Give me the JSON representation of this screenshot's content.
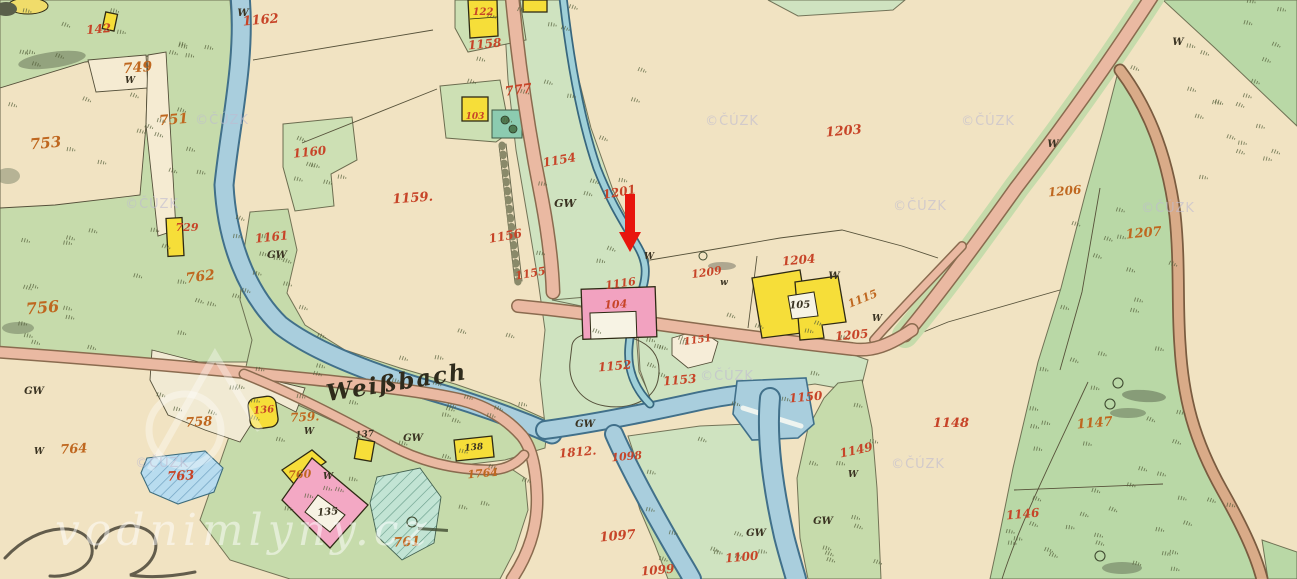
{
  "map": {
    "place_label": "Weißbach",
    "watermark_text": "vodnimlyny.cz",
    "copyright_watermark": "©ČÚZK",
    "copyright_positions": [
      [
        222,
        124
      ],
      [
        152,
        208
      ],
      [
        732,
        125
      ],
      [
        988,
        125
      ],
      [
        920,
        210
      ],
      [
        1168,
        212
      ],
      [
        162,
        467
      ],
      [
        727,
        380
      ],
      [
        918,
        468
      ]
    ],
    "arrow": {
      "x": 630,
      "y": 228,
      "color": "#e8150d"
    },
    "colors": {
      "paper_cream": "#f1e3c2",
      "meadow_green": "#c6dbab",
      "valley_green": "#cfe3c0",
      "river_blue": "#a9cedd",
      "road_pink": "#eab9a2",
      "building_yellow": "#f6de39",
      "building_pink": "#f2a2c0",
      "label_red": "#c74428",
      "label_orange": "#bf671f"
    },
    "labels": [
      {
        "t": "W",
        "x": 243,
        "y": 16,
        "c": "dark",
        "s": 10,
        "r": 0
      },
      {
        "t": "1162",
        "x": 261,
        "y": 24,
        "c": "red",
        "s": 13,
        "r": -5
      },
      {
        "t": "142",
        "x": 99,
        "y": 33,
        "c": "red",
        "s": 12,
        "r": -5
      },
      {
        "t": "749",
        "x": 138,
        "y": 72,
        "c": "orange",
        "s": 14,
        "r": -5
      },
      {
        "t": "W",
        "x": 130,
        "y": 83,
        "c": "dark",
        "s": 9,
        "r": 0
      },
      {
        "t": "751",
        "x": 174,
        "y": 124,
        "c": "orange",
        "s": 14,
        "r": -5
      },
      {
        "t": "753",
        "x": 46,
        "y": 148,
        "c": "orange",
        "s": 15,
        "r": -5
      },
      {
        "t": "1160",
        "x": 310,
        "y": 156,
        "c": "red",
        "s": 12,
        "r": -6
      },
      {
        "t": "1159.",
        "x": 413,
        "y": 202,
        "c": "red",
        "s": 13,
        "r": -4
      },
      {
        "t": "1161",
        "x": 272,
        "y": 241,
        "c": "red",
        "s": 12,
        "r": -6
      },
      {
        "t": "GW",
        "x": 277,
        "y": 258,
        "c": "dark",
        "s": 10,
        "r": 0
      },
      {
        "t": "762",
        "x": 201,
        "y": 281,
        "c": "orange",
        "s": 14,
        "r": -8
      },
      {
        "t": "756",
        "x": 43,
        "y": 313,
        "c": "orange",
        "s": 16,
        "r": -5
      },
      {
        "t": "729",
        "x": 187,
        "y": 231,
        "c": "red",
        "s": 11,
        "r": 0
      },
      {
        "t": "122",
        "x": 483,
        "y": 15,
        "c": "red",
        "s": 10,
        "r": 0
      },
      {
        "t": "1158",
        "x": 485,
        "y": 48,
        "c": "red",
        "s": 12,
        "r": -5
      },
      {
        "t": "777",
        "x": 519,
        "y": 94,
        "c": "red",
        "s": 13,
        "r": -8
      },
      {
        "t": "103",
        "x": 475,
        "y": 119,
        "c": "red",
        "s": 9,
        "r": 0
      },
      {
        "t": "1154",
        "x": 560,
        "y": 164,
        "c": "red",
        "s": 12,
        "r": -10
      },
      {
        "t": "GW",
        "x": 565,
        "y": 207,
        "c": "dark",
        "s": 11,
        "r": 0
      },
      {
        "t": "1201",
        "x": 620,
        "y": 196,
        "c": "red",
        "s": 12,
        "r": -10
      },
      {
        "t": "1156",
        "x": 506,
        "y": 240,
        "c": "red",
        "s": 12,
        "r": -10
      },
      {
        "t": "1155",
        "x": 531,
        "y": 277,
        "c": "red",
        "s": 11,
        "r": -10
      },
      {
        "t": "W",
        "x": 649,
        "y": 259,
        "c": "dark",
        "s": 9,
        "r": 0
      },
      {
        "t": "1203",
        "x": 844,
        "y": 135,
        "c": "red",
        "s": 13,
        "r": -5
      },
      {
        "t": "1209",
        "x": 707,
        "y": 276,
        "c": "red",
        "s": 11,
        "r": -8
      },
      {
        "t": "w",
        "x": 724,
        "y": 285,
        "c": "dark",
        "s": 9,
        "r": 0
      },
      {
        "t": "1204",
        "x": 799,
        "y": 264,
        "c": "red",
        "s": 12,
        "r": -5
      },
      {
        "t": "W",
        "x": 834,
        "y": 279,
        "c": "dark",
        "s": 10,
        "r": 0
      },
      {
        "t": "105",
        "x": 800,
        "y": 308,
        "c": "dark",
        "s": 10,
        "r": -3
      },
      {
        "t": "1115",
        "x": 864,
        "y": 302,
        "c": "orange",
        "s": 11,
        "r": -22
      },
      {
        "t": "1205",
        "x": 852,
        "y": 339,
        "c": "red",
        "s": 12,
        "r": -5
      },
      {
        "t": "W",
        "x": 877,
        "y": 321,
        "c": "dark",
        "s": 9,
        "r": 0
      },
      {
        "t": "1116",
        "x": 621,
        "y": 287,
        "c": "red",
        "s": 11,
        "r": -8
      },
      {
        "t": "104",
        "x": 616,
        "y": 308,
        "c": "red",
        "s": 11,
        "r": -3
      },
      {
        "t": "1151",
        "x": 698,
        "y": 343,
        "c": "red",
        "s": 10,
        "r": -8
      },
      {
        "t": "1152",
        "x": 615,
        "y": 370,
        "c": "red",
        "s": 12,
        "r": -5
      },
      {
        "t": "1153",
        "x": 680,
        "y": 384,
        "c": "red",
        "s": 12,
        "r": -5
      },
      {
        "t": "1150",
        "x": 806,
        "y": 401,
        "c": "red",
        "s": 12,
        "r": -5
      },
      {
        "t": "W",
        "x": 1053,
        "y": 147,
        "c": "dark",
        "s": 10,
        "r": 0
      },
      {
        "t": "W",
        "x": 1178,
        "y": 45,
        "c": "dark",
        "s": 10,
        "r": 0
      },
      {
        "t": "1206",
        "x": 1065,
        "y": 195,
        "c": "orange",
        "s": 12,
        "r": -5
      },
      {
        "t": "1207",
        "x": 1144,
        "y": 237,
        "c": "orange",
        "s": 13,
        "r": -5
      },
      {
        "t": "1148",
        "x": 951,
        "y": 427,
        "c": "red",
        "s": 13,
        "r": 0
      },
      {
        "t": "1149",
        "x": 857,
        "y": 454,
        "c": "red",
        "s": 12,
        "r": -12
      },
      {
        "t": "W",
        "x": 853,
        "y": 477,
        "c": "dark",
        "s": 9,
        "r": 0
      },
      {
        "t": "GW",
        "x": 823,
        "y": 524,
        "c": "dark",
        "s": 10,
        "r": 0
      },
      {
        "t": "GW",
        "x": 756,
        "y": 536,
        "c": "dark",
        "s": 10,
        "r": 0
      },
      {
        "t": "1147",
        "x": 1095,
        "y": 427,
        "c": "orange",
        "s": 13,
        "r": -5
      },
      {
        "t": "1146",
        "x": 1023,
        "y": 518,
        "c": "red",
        "s": 12,
        "r": -5
      },
      {
        "t": "1100",
        "x": 742,
        "y": 561,
        "c": "red",
        "s": 12,
        "r": -5
      },
      {
        "t": "1097",
        "x": 618,
        "y": 540,
        "c": "red",
        "s": 13,
        "r": -5
      },
      {
        "t": "1099",
        "x": 658,
        "y": 574,
        "c": "red",
        "s": 12,
        "r": -5
      },
      {
        "t": "1812.",
        "x": 578,
        "y": 456,
        "c": "red",
        "s": 12,
        "r": -5
      },
      {
        "t": "1098",
        "x": 627,
        "y": 460,
        "c": "red",
        "s": 11,
        "r": -5
      },
      {
        "t": "1764",
        "x": 483,
        "y": 477,
        "c": "orange",
        "s": 11,
        "r": -5
      },
      {
        "t": "GW",
        "x": 585,
        "y": 427,
        "c": "dark",
        "s": 10,
        "r": 0
      },
      {
        "t": "GW",
        "x": 413,
        "y": 441,
        "c": "dark",
        "s": 10,
        "r": 0
      },
      {
        "t": "137",
        "x": 365,
        "y": 437,
        "c": "dark",
        "s": 9,
        "r": -5
      },
      {
        "t": "138",
        "x": 474,
        "y": 450,
        "c": "dark",
        "s": 9,
        "r": -5
      },
      {
        "t": "759.",
        "x": 305,
        "y": 421,
        "c": "orange",
        "s": 12,
        "r": -3
      },
      {
        "t": "W",
        "x": 309,
        "y": 434,
        "c": "dark",
        "s": 9,
        "r": 0
      },
      {
        "t": "758",
        "x": 199,
        "y": 426,
        "c": "orange",
        "s": 13,
        "r": -3
      },
      {
        "t": "136",
        "x": 264,
        "y": 413,
        "c": "red",
        "s": 10,
        "r": -5
      },
      {
        "t": "GW",
        "x": 34,
        "y": 394,
        "c": "dark",
        "s": 10,
        "r": 0
      },
      {
        "t": "W",
        "x": 39,
        "y": 454,
        "c": "dark",
        "s": 9,
        "r": 0
      },
      {
        "t": "764",
        "x": 74,
        "y": 453,
        "c": "orange",
        "s": 13,
        "r": -3
      },
      {
        "t": "763",
        "x": 181,
        "y": 480,
        "c": "red",
        "s": 13,
        "r": -3
      },
      {
        "t": "760",
        "x": 300,
        "y": 478,
        "c": "orange",
        "s": 11,
        "r": -3
      },
      {
        "t": "W",
        "x": 328,
        "y": 479,
        "c": "dark",
        "s": 9,
        "r": 0
      },
      {
        "t": "135",
        "x": 328,
        "y": 515,
        "c": "dark",
        "s": 10,
        "r": -5
      },
      {
        "t": "761",
        "x": 407,
        "y": 546,
        "c": "orange",
        "s": 13,
        "r": -3
      }
    ]
  }
}
